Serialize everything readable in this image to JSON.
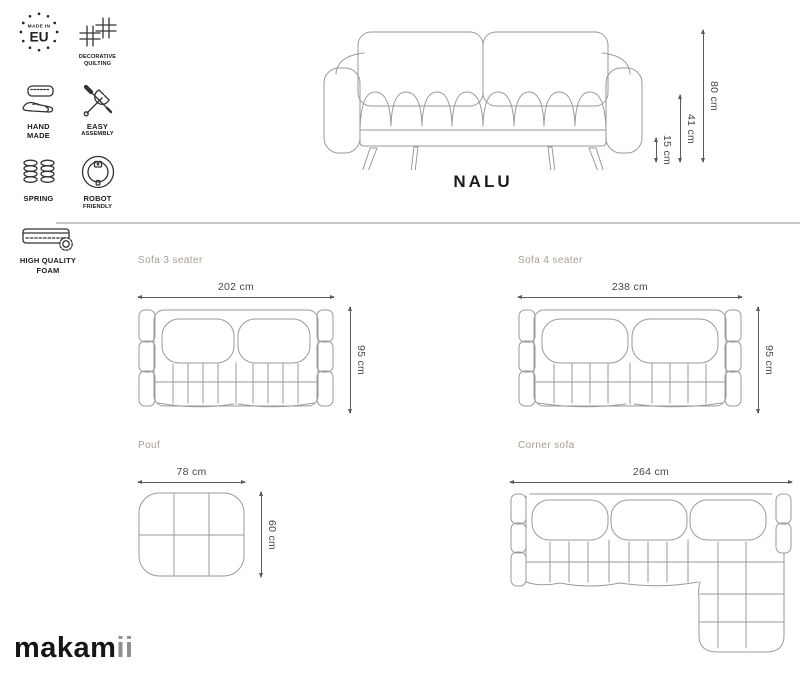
{
  "colors": {
    "background": "#ffffff",
    "furniture_line": "#9a9a9a",
    "icon_ink": "#333333",
    "section_label": "#a79f92",
    "dimension_ink": "#474747",
    "divider": "#c9c7c4",
    "title_ink": "#1c1c1c",
    "logo_ink": "#161616",
    "logo_suffix_ink": "#8f8f8f"
  },
  "features": [
    {
      "name": "made-in-eu",
      "badge_small": "MADE IN",
      "badge_large": "EU"
    },
    {
      "name": "decorative-quilting",
      "lines": [
        "DECORATIVE",
        "QUILTING"
      ]
    },
    {
      "name": "hand-made",
      "lines": [
        "HAND",
        "MADE"
      ]
    },
    {
      "name": "easy-assembly",
      "lines": [
        "EASY",
        "ASSEMBLY"
      ]
    },
    {
      "name": "spring",
      "lines": [
        "SPRING"
      ]
    },
    {
      "name": "robot-friendly",
      "lines": [
        "ROBOT",
        "FRIENDLY"
      ]
    },
    {
      "name": "high-quality-foam",
      "lines": [
        "HIGH QUALITY",
        "FOAM"
      ]
    }
  ],
  "hero": {
    "title": "NALU",
    "dimensions": {
      "height": "80 cm",
      "seat_height": "41 cm",
      "leg_height": "15 cm"
    }
  },
  "variants": [
    {
      "name": "Sofa 3 seater",
      "width": "202 cm",
      "depth": "95 cm"
    },
    {
      "name": "Sofa 4 seater",
      "width": "238 cm",
      "depth": "95 cm"
    },
    {
      "name": "Pouf",
      "width": "78 cm",
      "depth": "60 cm"
    },
    {
      "name": "Corner sofa",
      "width": "264 cm"
    }
  ],
  "brand": {
    "logo_main": "makam",
    "logo_suffix": "ii"
  }
}
